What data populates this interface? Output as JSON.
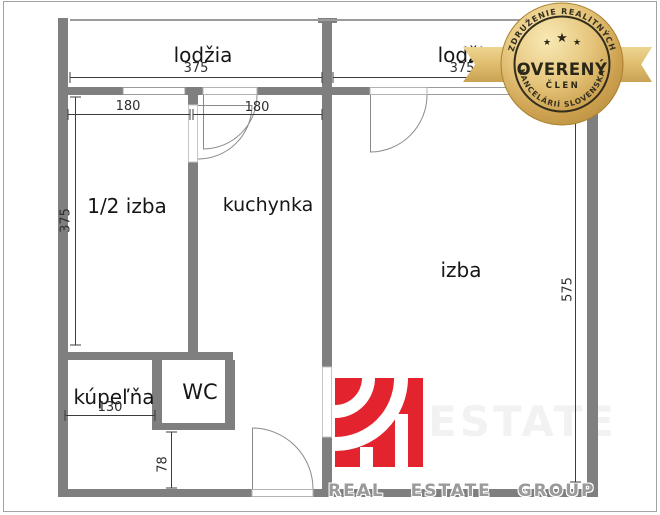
{
  "plan": {
    "wall_color": "#7f7f7f",
    "thin_line_color": "#9b9b9b",
    "dimension_line_color": "#3c3c3c",
    "rooms": [
      {
        "id": "lodzia-left",
        "label": "lodžia"
      },
      {
        "id": "lodzia-right",
        "label": "lodžia"
      },
      {
        "id": "polizba",
        "label": "1/2 izba"
      },
      {
        "id": "kuchynka",
        "label": "kuchynka"
      },
      {
        "id": "izba",
        "label": "izba"
      },
      {
        "id": "kupelna",
        "label": "kúpeľňa"
      },
      {
        "id": "wc",
        "label": "WC"
      }
    ],
    "dimensions": [
      {
        "id": "dim-lodzia-left-width",
        "value": "375"
      },
      {
        "id": "dim-lodzia-right-width",
        "value": "375"
      },
      {
        "id": "dim-polizba-width",
        "value": "180"
      },
      {
        "id": "dim-kuchynka-width",
        "value": "180"
      },
      {
        "id": "dim-polizba-height",
        "value": "375"
      },
      {
        "id": "dim-izba-height",
        "value": "575"
      },
      {
        "id": "dim-kupelna-width",
        "value": "130"
      },
      {
        "id": "dim-hall-height",
        "value": "78"
      }
    ]
  },
  "badge": {
    "top_text": "ZDRUŽENIE REALITNÝCH",
    "bottom_text": "KANCELÁRIÍ SLOVENSKA",
    "main_text": "OVERENÝ",
    "sub_text": "ČLEN",
    "star": "★",
    "gold_color": "#d8b167"
  },
  "watermark": {
    "footer_text": "REAL ESTATE GROUP",
    "faint_text": "ESTATE",
    "logo_color": "#e3232e",
    "text_color": "#9a9a9a"
  }
}
